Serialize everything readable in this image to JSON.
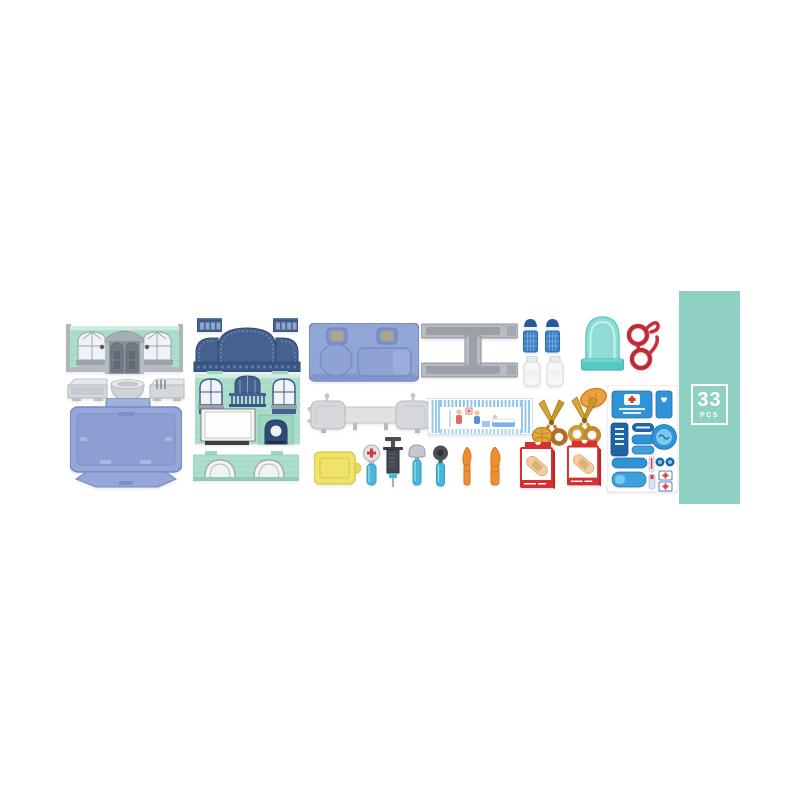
{
  "image": {
    "type": "product-photo",
    "background": "#ffffff"
  },
  "banner": {
    "count": "33",
    "unit": "PCS"
  },
  "palette": {
    "banner_teal": "#8ed1c2",
    "mint_wall": "#abdecb",
    "mint_light": "#cfeee1",
    "mint_line": "#93cdb8",
    "roof_navy": "#46618f",
    "navy_dark": "#2e4a75",
    "periwinkle": "#94a7d8",
    "periwinkle_dark": "#7588bd",
    "furniture_gray": "#b7bbc2",
    "sofa_gray": "#d6d7da",
    "dome_teal": "#8edcd5",
    "dome_teal_dark": "#57c9c0",
    "glasses_red": "#c5303c",
    "vial_blue": "#3f81c4",
    "bottle_white": "#f6f7f8",
    "awning_blue": "#8ec3ea",
    "scissors_gold": "#cf9a30",
    "tool_orange": "#ef8f33",
    "board_yellow": "#efe46a",
    "handle_teal": "#49b7d8",
    "tool_dark": "#43474f",
    "box_red": "#d63030",
    "bandaid_beige": "#eecda0",
    "sticker_blue": "#2f93d6",
    "sticker_navy": "#1f63a8",
    "sticker_light": "#7cc9ef"
  },
  "pieces": [
    "shop-front-wall",
    "counter-sink",
    "wash-basin",
    "utensil-holder",
    "floor-base-plate",
    "roof-dormer-left",
    "roof-dormer-right",
    "mansard-roof",
    "clinic-wall",
    "arch-fence",
    "room-floor-plate",
    "bed-frame",
    "medicine-vial-1",
    "medicine-vial-2",
    "pill-bottle-1",
    "pill-bottle-2",
    "arch-mirror",
    "eyeglasses",
    "sofa-table-set",
    "clinic-awning-panel",
    "bread-loaf",
    "toy-scissors-1",
    "toy-scissors-2",
    "cookie",
    "sticker-sheet",
    "cutting-board",
    "otoscope",
    "syringe",
    "reflex-hammer",
    "magnifier",
    "scalpel",
    "toy-knife",
    "bandage-box-1",
    "bandage-box-2"
  ]
}
